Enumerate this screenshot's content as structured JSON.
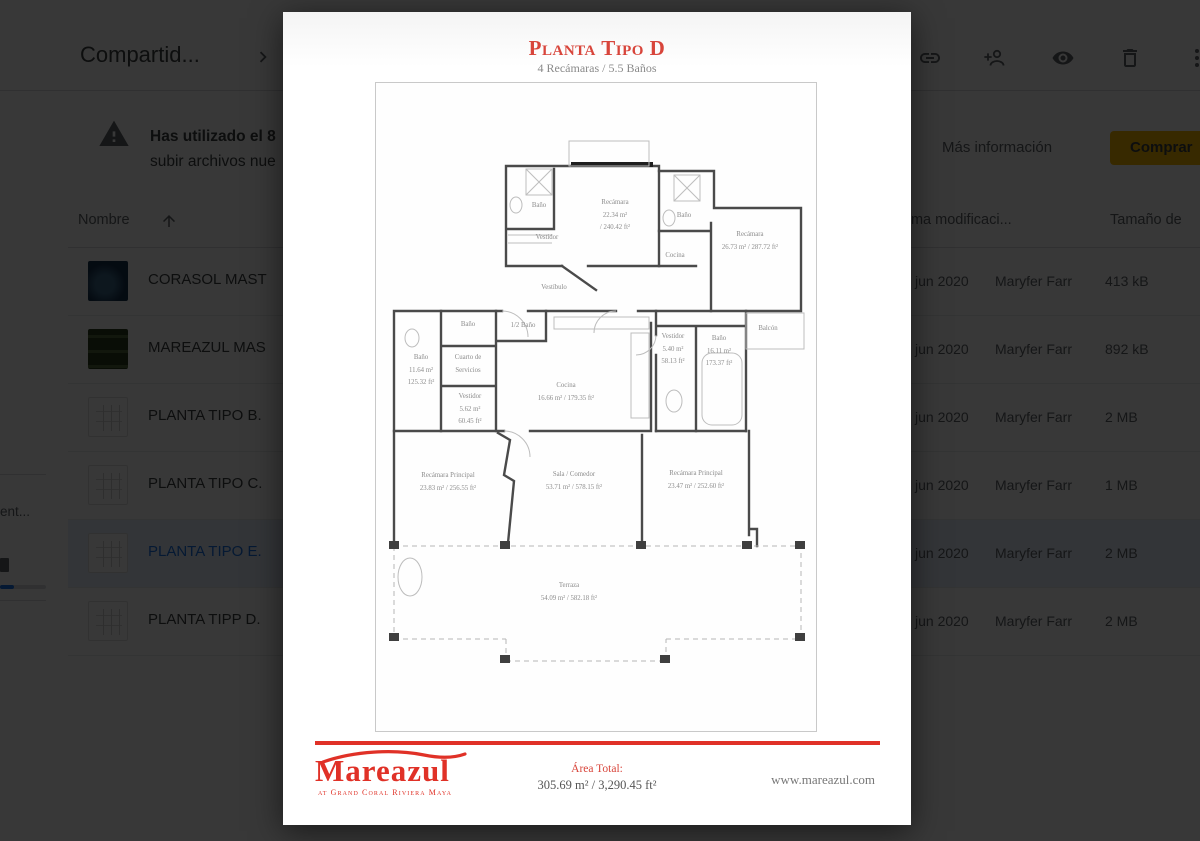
{
  "colors": {
    "accent_red": "#e03127",
    "title_red": "#d8453b",
    "selected_blue": "#1a73e8",
    "buy_yellow": "#fbbc04",
    "icon_gray": "#5f6368"
  },
  "drive": {
    "breadcrumb": "Compartid...",
    "toolbar_icons": [
      "link-icon",
      "person-add-icon",
      "preview-icon",
      "delete-icon",
      "more-vert-icon"
    ],
    "warning": {
      "title": "Has utilizado el 8",
      "body": "subir archivos nue",
      "more_info": "Más información",
      "buy_button": "Comprar"
    },
    "table": {
      "col_name": "Nombre",
      "col_modified": "Última modificaci...",
      "col_size": "Tamaño de",
      "rows": [
        {
          "name": "CORASOL MAST",
          "modified": "jun 2020",
          "owner": "Maryfer Farr",
          "size": "413 kB",
          "selected": false
        },
        {
          "name": "MAREAZUL MAS",
          "modified": "jun 2020",
          "owner": "Maryfer Farr",
          "size": "892 kB",
          "selected": false
        },
        {
          "name": "PLANTA TIPO B.",
          "modified": "jun 2020",
          "owner": "Maryfer Farr",
          "size": "2 MB",
          "selected": false
        },
        {
          "name": "PLANTA TIPO C.",
          "modified": "jun 2020",
          "owner": "Maryfer Farr",
          "size": "1 MB",
          "selected": false
        },
        {
          "name": "PLANTA TIPO E.",
          "modified": "jun 2020",
          "owner": "Maryfer Farr",
          "size": "2 MB",
          "selected": true
        },
        {
          "name": "PLANTA TIPP D.",
          "modified": "jun 2020",
          "owner": "Maryfer Farr",
          "size": "2 MB",
          "selected": false
        }
      ]
    },
    "sidebar": {
      "storage_text": "ent...",
      "progress_percent": 30
    }
  },
  "preview": {
    "title": "Planta Tipo D",
    "subtitle": "4 Recámaras / 5.5 Baños",
    "plan": {
      "rooms": [
        {
          "id": "bano-1",
          "lines": [
            "Baño"
          ]
        },
        {
          "id": "recamara-1",
          "lines": [
            "Recámara",
            "22.34 m²",
            "/ 240.42 ft²"
          ]
        },
        {
          "id": "vestidor-1",
          "lines": [
            "Vestidor"
          ]
        },
        {
          "id": "bano-2",
          "lines": [
            "Baño"
          ]
        },
        {
          "id": "cocina-mueble",
          "lines": [
            "Cocina"
          ]
        },
        {
          "id": "recamara-2",
          "lines": [
            "Recámara",
            "26.73 m² / 287.72 ft²"
          ]
        },
        {
          "id": "vestibulo",
          "lines": [
            "Vestíbulo"
          ]
        },
        {
          "id": "bano-3",
          "lines": [
            "Baño"
          ]
        },
        {
          "id": "medio-bano",
          "lines": [
            "1/2 Baño"
          ]
        },
        {
          "id": "bano-4",
          "lines": [
            "Baño",
            "11.64 m²",
            "125.32 ft²"
          ]
        },
        {
          "id": "cuarto-servicios",
          "lines": [
            "Cuarto de",
            "Servicios"
          ]
        },
        {
          "id": "vestidor-servicio",
          "lines": [
            "Vestidor",
            "5.62 m²",
            "60.45 ft²"
          ]
        },
        {
          "id": "cocina",
          "lines": [
            "Cocina",
            "16.66 m² / 179.35 ft²"
          ]
        },
        {
          "id": "vestidor-2",
          "lines": [
            "Vestidor",
            "5.40 m²",
            "58.13 ft²"
          ]
        },
        {
          "id": "bano-5",
          "lines": [
            "Baño",
            "16.11 m²",
            "173.37 ft²"
          ]
        },
        {
          "id": "balcon",
          "lines": [
            "Balcón"
          ]
        },
        {
          "id": "recamara-principal-izq",
          "lines": [
            "Recámara Principal",
            "23.83 m² / 256.55 ft²"
          ]
        },
        {
          "id": "sala-comedor",
          "lines": [
            "Sala / Comedor",
            "53.71 m² / 578.15 ft²"
          ]
        },
        {
          "id": "recamara-principal-der",
          "lines": [
            "Recámara Principal",
            "23.47 m² / 252.60 ft²"
          ]
        },
        {
          "id": "terraza",
          "lines": [
            "Terraza",
            "54.09 m² / 582.18 ft²"
          ]
        }
      ]
    },
    "footer": {
      "brand": "Mareazul",
      "tagline": "at Grand Coral Riviera Maya",
      "area_label": "Área Total:",
      "area_value": "305.69 m² / 3,290.45 ft²",
      "website": "www.mareazul.com"
    }
  }
}
